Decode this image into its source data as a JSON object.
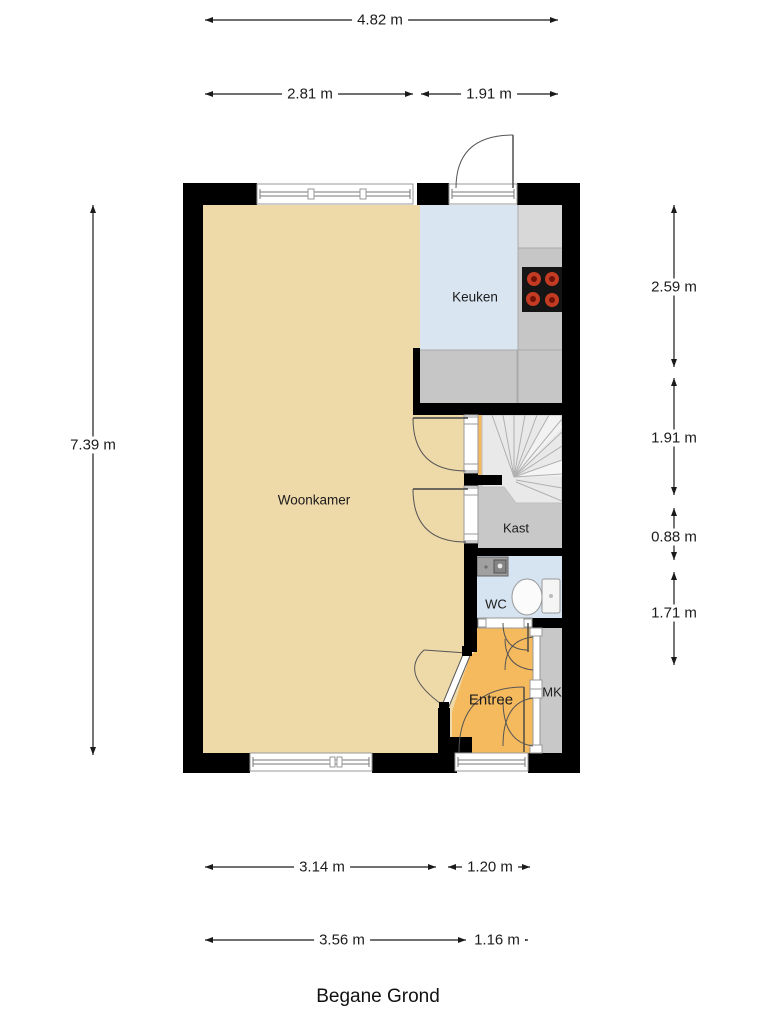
{
  "title": "Begane Grond",
  "rooms": [
    {
      "name": "Woonkamer"
    },
    {
      "name": "Keuken"
    },
    {
      "name": "Kast"
    },
    {
      "name": "WC"
    },
    {
      "name": "Entree"
    },
    {
      "name": "MK"
    }
  ],
  "dimensions": {
    "top": [
      {
        "label": "4.82 m"
      },
      {
        "label": "2.81 m"
      },
      {
        "label": "1.91 m"
      }
    ],
    "left": [
      {
        "label": "7.39 m"
      }
    ],
    "right": [
      {
        "label": "2.59 m"
      },
      {
        "label": "1.91 m"
      },
      {
        "label": "0.88 m"
      },
      {
        "label": "1.71 m"
      }
    ],
    "bottom": [
      {
        "label": "3.14 m"
      },
      {
        "label": "1.20 m"
      },
      {
        "label": "3.56 m"
      },
      {
        "label": "1.16 m"
      }
    ]
  },
  "fixtures": [
    {
      "name": "stove"
    },
    {
      "name": "kitchen-counter"
    },
    {
      "name": "sink"
    },
    {
      "name": "toilet"
    },
    {
      "name": "winder-stairs"
    }
  ],
  "colors": {
    "woonkamer": "#eed9a9",
    "keuken": "#d9e6f2",
    "wc": "#d6e3f0",
    "entree": "#f5b95e",
    "counter": "#c6c6c6",
    "counter_light": "#d8d8d8",
    "kast": "#c8c8c8",
    "stairs": "#e9e9e9",
    "wall": "#000000",
    "burner": "#c23b22"
  }
}
